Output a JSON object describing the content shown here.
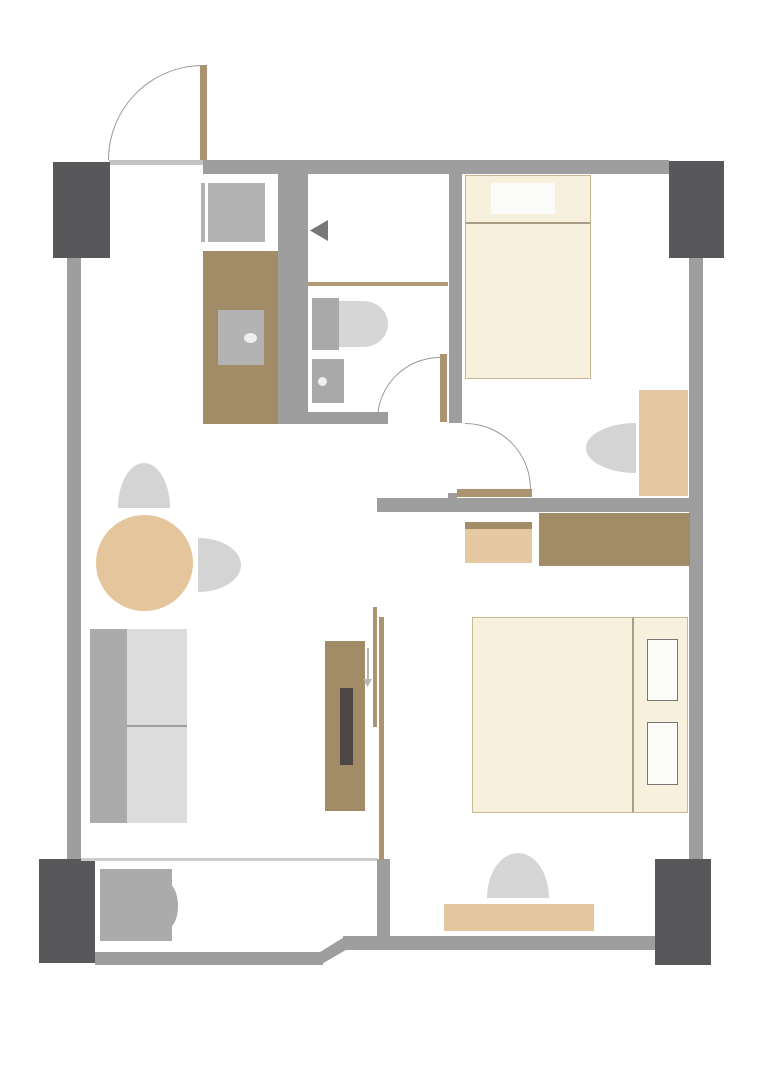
{
  "title": "apartment-floor-plan",
  "canvas": {
    "width": 763,
    "height": 1080,
    "background": "#ffffff"
  },
  "palette": {
    "wall": "#9e9e9e",
    "pillar": "#58585a",
    "doorLeaf": "#ac9372",
    "arcLine": "#9a9a9a",
    "darkTan": "#a28c68",
    "lightTan": "#e5c9a2",
    "tableTan": "#e5c69c",
    "benchTan": "#e2c79f",
    "cream": "#f7f0dc",
    "creamBorder": "#c9b896",
    "bedLine": "#a99e85",
    "lightGray": "#d6d6d6",
    "chairGray": "#d4d4d4",
    "midGray": "#ababab",
    "applianceGray": "#b3b3b3",
    "fixtureGray": "#a9a9a9",
    "seatGray": "#dcdcdc",
    "windowLine": "#cccccc",
    "threshold": "#c4c4c4",
    "arrowGray": "#77777a",
    "slideArrow": "#b5b5b5",
    "tanLine": "#b09a78",
    "tvDark": "#4e4545",
    "pillowWhite": "#fbfbf7",
    "pillowBorder": "#76767a",
    "dotWhite": "#f0f0f0"
  },
  "elements": [
    {
      "name": "top-wall",
      "shape": "rect",
      "x": 203,
      "y": 160,
      "w": 466,
      "h": 14,
      "color": "wall"
    },
    {
      "name": "entry-threshold-line",
      "shape": "rect",
      "x": 109,
      "y": 160,
      "w": 94,
      "h": 5,
      "color": "threshold"
    },
    {
      "name": "left-wall",
      "shape": "rect",
      "x": 67,
      "y": 258,
      "w": 14,
      "h": 602,
      "color": "wall"
    },
    {
      "name": "right-wall",
      "shape": "rect",
      "x": 689,
      "y": 258,
      "w": 14,
      "h": 601,
      "color": "wall"
    },
    {
      "name": "pillar-top-left",
      "shape": "rect",
      "x": 53,
      "y": 162,
      "w": 57,
      "h": 96,
      "color": "pillar"
    },
    {
      "name": "pillar-top-right",
      "shape": "rect",
      "x": 669,
      "y": 161,
      "w": 55,
      "h": 97,
      "color": "pillar"
    },
    {
      "name": "pillar-bottom-left",
      "shape": "rect",
      "x": 39,
      "y": 859,
      "w": 56,
      "h": 104,
      "color": "pillar"
    },
    {
      "name": "pillar-bottom-right",
      "shape": "rect",
      "x": 655,
      "y": 859,
      "w": 56,
      "h": 106,
      "color": "pillar"
    },
    {
      "name": "bathroom-west-wall",
      "shape": "rect",
      "x": 278,
      "y": 173,
      "w": 30,
      "h": 251,
      "color": "wall"
    },
    {
      "name": "bedroom-divider-wall",
      "shape": "rect",
      "x": 449,
      "y": 173,
      "w": 13,
      "h": 250,
      "color": "wall"
    },
    {
      "name": "bathroom-south-wall",
      "shape": "rect",
      "x": 308,
      "y": 412,
      "w": 80,
      "h": 12,
      "color": "wall"
    },
    {
      "name": "middle-wall",
      "shape": "rect",
      "x": 377,
      "y": 498,
      "w": 326,
      "h": 14,
      "color": "wall"
    },
    {
      "name": "middle-wall-nub",
      "shape": "rect",
      "x": 448,
      "y": 493,
      "w": 9,
      "h": 6,
      "color": "wall"
    },
    {
      "name": "bedroom-south-wall",
      "shape": "rect",
      "x": 343,
      "y": 936,
      "w": 312,
      "h": 14,
      "color": "wall"
    },
    {
      "name": "wall-step-diagonal",
      "shape": "rect",
      "x": 320,
      "y": 936,
      "w": 26,
      "h": 29,
      "color": "wall",
      "clip": "polygon(0 55%, 100% 0, 100% 48%, 0 100%)"
    },
    {
      "name": "balcony-south-wall",
      "shape": "rect",
      "x": 95,
      "y": 952,
      "w": 228,
      "h": 13,
      "color": "wall"
    },
    {
      "name": "balcony-divider-wall",
      "shape": "rect",
      "x": 377,
      "y": 859,
      "w": 13,
      "h": 91,
      "color": "wall"
    },
    {
      "name": "balcony-window-line",
      "shape": "rect",
      "x": 81,
      "y": 858,
      "w": 296,
      "h": 3,
      "color": "windowLine"
    },
    {
      "name": "kitchen-appliance-line",
      "shape": "rect",
      "x": 201,
      "y": 183,
      "w": 4,
      "h": 59,
      "color": "applianceGray"
    },
    {
      "name": "kitchen-appliance",
      "shape": "rect",
      "x": 208,
      "y": 183,
      "w": 57,
      "h": 59,
      "color": "applianceGray"
    },
    {
      "name": "kitchen-counter",
      "shape": "rect",
      "x": 203,
      "y": 251,
      "w": 75,
      "h": 173,
      "color": "darkTan"
    },
    {
      "name": "kitchen-sink",
      "shape": "rect",
      "x": 218,
      "y": 310,
      "w": 46,
      "h": 55,
      "color": "applianceGray"
    },
    {
      "name": "kitchen-sink-dot",
      "shape": "rect",
      "x": 244,
      "y": 333,
      "w": 13,
      "h": 10,
      "color": "dotWhite",
      "radius": "50%"
    },
    {
      "name": "shower-arrow-icon",
      "shape": "tri-left",
      "x": 310,
      "y": 220,
      "w": 18,
      "h": 21,
      "color": "arrowGray"
    },
    {
      "name": "bathroom-divider-line",
      "shape": "rect",
      "x": 308,
      "y": 282,
      "w": 140,
      "h": 4,
      "color": "tanLine"
    },
    {
      "name": "toilet-tank",
      "shape": "rect",
      "x": 312,
      "y": 298,
      "w": 27,
      "h": 52,
      "color": "fixtureGray"
    },
    {
      "name": "toilet-bowl",
      "shape": "rect",
      "x": 339,
      "y": 301,
      "w": 49,
      "h": 46,
      "color": "lightGray",
      "radius": "0 50% 50% 0 / 0 50% 50% 0"
    },
    {
      "name": "bathroom-sink",
      "shape": "rect",
      "x": 312,
      "y": 359,
      "w": 32,
      "h": 44,
      "color": "fixtureGray"
    },
    {
      "name": "bathroom-sink-dot",
      "shape": "rect",
      "x": 318,
      "y": 377,
      "w": 9,
      "h": 9,
      "color": "dotWhite",
      "radius": "50%"
    },
    {
      "name": "single-bed",
      "shape": "rect",
      "x": 465,
      "y": 175,
      "w": 126,
      "h": 204,
      "color": "cream",
      "border": "creamBorder"
    },
    {
      "name": "single-bed-pillow",
      "shape": "rect",
      "x": 491,
      "y": 183,
      "w": 64,
      "h": 31,
      "color": "pillowWhite"
    },
    {
      "name": "single-bed-line",
      "shape": "rect",
      "x": 466,
      "y": 222,
      "w": 124,
      "h": 2,
      "color": "bedLine"
    },
    {
      "name": "desk-chair",
      "shape": "rect",
      "x": 586,
      "y": 423,
      "w": 50,
      "h": 50,
      "color": "chairGray",
      "radius": "100% 0 0 100% / 50% 0 0 50%"
    },
    {
      "name": "desk",
      "shape": "rect",
      "x": 639,
      "y": 390,
      "w": 49,
      "h": 106,
      "color": "lightTan"
    },
    {
      "name": "nightstand-top-strip",
      "shape": "rect",
      "x": 465,
      "y": 522,
      "w": 67,
      "h": 7,
      "color": "darkTan"
    },
    {
      "name": "nightstand",
      "shape": "rect",
      "x": 465,
      "y": 529,
      "w": 67,
      "h": 34,
      "color": "lightTan"
    },
    {
      "name": "dresser",
      "shape": "rect",
      "x": 539,
      "y": 513,
      "w": 151,
      "h": 53,
      "color": "darkTan"
    },
    {
      "name": "dining-chair-top",
      "shape": "rect",
      "x": 118,
      "y": 463,
      "w": 52,
      "h": 45,
      "color": "chairGray",
      "radius": "50% 50% 0 0 / 100% 100% 0 0"
    },
    {
      "name": "dining-table",
      "shape": "rect",
      "x": 96,
      "y": 515,
      "w": 97,
      "h": 96,
      "color": "tableTan",
      "radius": "50%"
    },
    {
      "name": "dining-chair-right",
      "shape": "rect",
      "x": 198,
      "y": 538,
      "w": 43,
      "h": 54,
      "color": "chairGray",
      "radius": "0 100% 100% 0 / 0 50% 50% 0"
    },
    {
      "name": "sofa-back",
      "shape": "rect",
      "x": 90,
      "y": 629,
      "w": 37,
      "h": 194,
      "color": "midGray"
    },
    {
      "name": "sofa-seat",
      "shape": "rect",
      "x": 127,
      "y": 629,
      "w": 60,
      "h": 194,
      "color": "seatGray"
    },
    {
      "name": "sofa-seat-line",
      "shape": "rect",
      "x": 127,
      "y": 725,
      "w": 60,
      "h": 2,
      "color": "wall"
    },
    {
      "name": "tv-console",
      "shape": "rect",
      "x": 325,
      "y": 641,
      "w": 40,
      "h": 170,
      "color": "darkTan"
    },
    {
      "name": "tv-screen",
      "shape": "rect",
      "x": 340,
      "y": 688,
      "w": 13,
      "h": 77,
      "color": "tvDark"
    },
    {
      "name": "partition-rail-short",
      "shape": "rect",
      "x": 373,
      "y": 607,
      "w": 4,
      "h": 120,
      "color": "doorLeaf"
    },
    {
      "name": "partition-rail-long",
      "shape": "rect",
      "x": 379,
      "y": 617,
      "w": 5,
      "h": 243,
      "color": "doorLeaf"
    },
    {
      "name": "slide-arrow-line",
      "shape": "rect",
      "x": 367,
      "y": 648,
      "w": 2,
      "h": 32,
      "color": "slideArrow"
    },
    {
      "name": "slide-arrow-head",
      "shape": "tri-down",
      "x": 363,
      "y": 679,
      "w": 9,
      "h": 8,
      "color": "slideArrow"
    },
    {
      "name": "double-bed",
      "shape": "rect",
      "x": 472,
      "y": 617,
      "w": 216,
      "h": 196,
      "color": "cream",
      "border": "creamBorder"
    },
    {
      "name": "double-bed-line",
      "shape": "rect",
      "x": 632,
      "y": 618,
      "w": 2,
      "h": 194,
      "color": "bedLine"
    },
    {
      "name": "bed-pillow-1",
      "shape": "rect",
      "x": 647,
      "y": 639,
      "w": 31,
      "h": 62,
      "color": "pillowWhite",
      "border": "pillowBorder"
    },
    {
      "name": "bed-pillow-2",
      "shape": "rect",
      "x": 647,
      "y": 722,
      "w": 31,
      "h": 63,
      "color": "pillowWhite",
      "border": "pillowBorder"
    },
    {
      "name": "bed-stool",
      "shape": "rect",
      "x": 487,
      "y": 853,
      "w": 62,
      "h": 45,
      "color": "lightGray",
      "radius": "50% 50% 0 0 / 100% 100% 0 0"
    },
    {
      "name": "bed-bench",
      "shape": "rect",
      "x": 444,
      "y": 904,
      "w": 150,
      "h": 27,
      "color": "benchTan"
    },
    {
      "name": "balcony-unit",
      "shape": "rect",
      "x": 100,
      "y": 869,
      "w": 72,
      "h": 72,
      "color": "midGray"
    },
    {
      "name": "balcony-unit-bump",
      "shape": "rect",
      "x": 168,
      "y": 884,
      "w": 10,
      "h": 44,
      "color": "midGray",
      "radius": "0 100% 100% 0 / 0 50% 50% 0"
    },
    {
      "name": "entry-door-arc",
      "shape": "arc-tl",
      "x": 108,
      "y": 65,
      "w": 95,
      "h": 95,
      "color": "arcLine"
    },
    {
      "name": "entry-door-leaf",
      "shape": "rect",
      "x": 200,
      "y": 65,
      "w": 7,
      "h": 95,
      "color": "doorLeaf"
    },
    {
      "name": "bathroom-door-arc",
      "shape": "arc-tl",
      "x": 377,
      "y": 357,
      "w": 63,
      "h": 63,
      "color": "arcLine"
    },
    {
      "name": "bathroom-door-leaf",
      "shape": "rect",
      "x": 440,
      "y": 354,
      "w": 7,
      "h": 68,
      "color": "doorLeaf"
    },
    {
      "name": "bedroom-door-arc",
      "shape": "arc-tr",
      "x": 465,
      "y": 423,
      "w": 66,
      "h": 66,
      "color": "arcLine"
    },
    {
      "name": "bedroom-door-leaf",
      "shape": "rect",
      "x": 457,
      "y": 489,
      "w": 75,
      "h": 8,
      "color": "doorLeaf"
    }
  ]
}
